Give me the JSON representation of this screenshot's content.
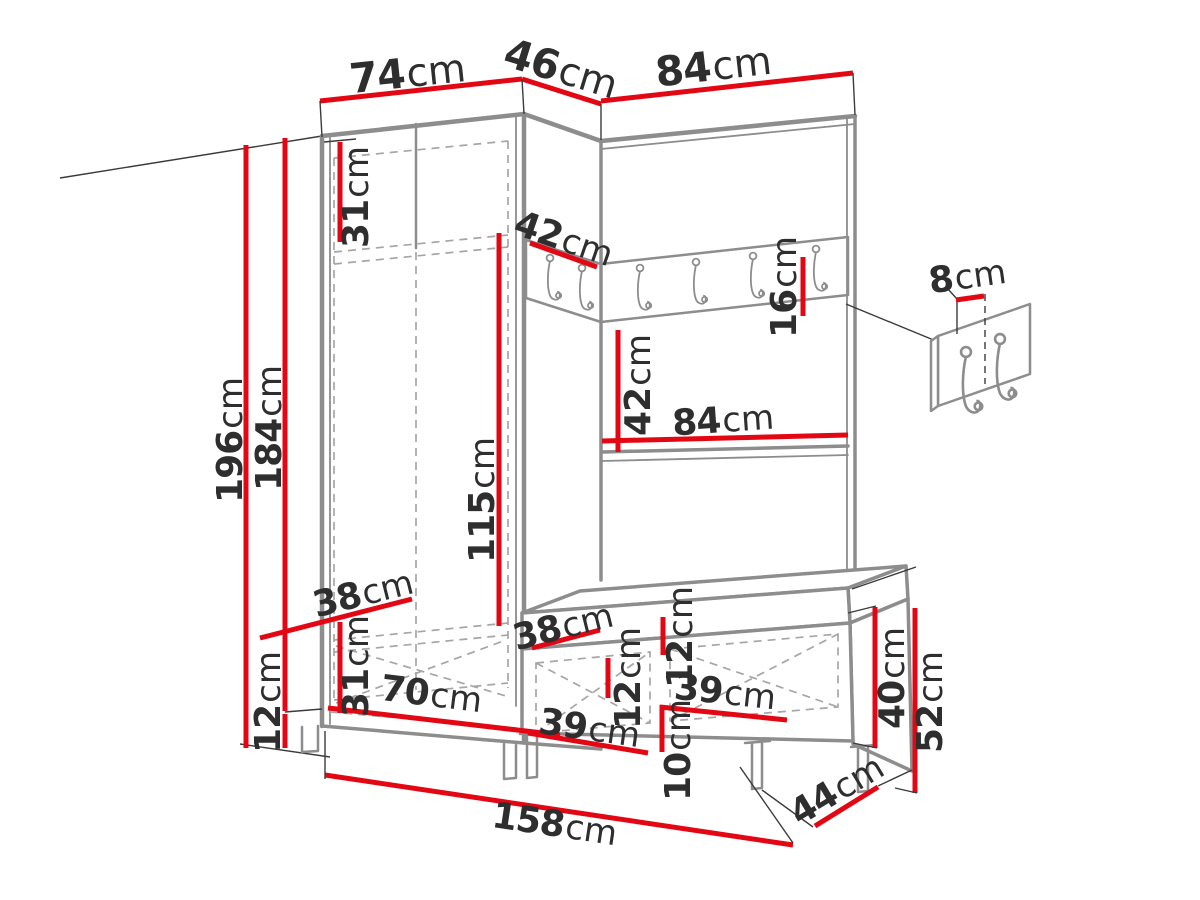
{
  "meta": {
    "unit": "cm",
    "diagram": "hallway-furniture-set-dimensions"
  },
  "colors": {
    "red": "#e30613",
    "gray": "#8d8d8d",
    "gray_light": "#b4b4b4",
    "dash": "#a6a6a6",
    "ink": "#2e2e2e",
    "black": "#3b3b3b",
    "bg": "#ffffff"
  },
  "dims": [
    {
      "id": "wardrobe-width-top",
      "v": "74",
      "u": "cm"
    },
    {
      "id": "corner-width-top",
      "v": "46",
      "u": "cm"
    },
    {
      "id": "panel-width-top",
      "v": "84",
      "u": "cm"
    },
    {
      "id": "top-shelf-height",
      "v": "31",
      "u": "cm"
    },
    {
      "id": "corner-shelf-width",
      "v": "42",
      "u": "cm"
    },
    {
      "id": "hook-rail-height",
      "v": "16",
      "u": "cm"
    },
    {
      "id": "hanging-space-height",
      "v": "115",
      "u": "cm"
    },
    {
      "id": "total-height",
      "v": "196",
      "u": "cm"
    },
    {
      "id": "side-panel-height",
      "v": "184",
      "u": "cm"
    },
    {
      "id": "rail-to-shelf-height",
      "v": "42",
      "u": "cm"
    },
    {
      "id": "shelf-width",
      "v": "84",
      "u": "cm"
    },
    {
      "id": "hook-spacing-detail",
      "v": "8",
      "u": "cm"
    },
    {
      "id": "wardrobe-depth",
      "v": "38",
      "u": "cm"
    },
    {
      "id": "bottom-section-height",
      "v": "31",
      "u": "cm"
    },
    {
      "id": "plinth-height",
      "v": "12",
      "u": "cm"
    },
    {
      "id": "interior-width",
      "v": "70",
      "u": "cm"
    },
    {
      "id": "bench-depth-left",
      "v": "38",
      "u": "cm"
    },
    {
      "id": "cushion-thickness-left",
      "v": "12",
      "u": "cm"
    },
    {
      "id": "cushion-thickness-right",
      "v": "12",
      "u": "cm"
    },
    {
      "id": "bench-compartment-left-width",
      "v": "39",
      "u": "cm"
    },
    {
      "id": "bench-compartment-right-width",
      "v": "39",
      "u": "cm"
    },
    {
      "id": "bench-leg-height",
      "v": "10",
      "u": "cm"
    },
    {
      "id": "bench-body-height",
      "v": "40",
      "u": "cm"
    },
    {
      "id": "bench-total-height",
      "v": "52",
      "u": "cm"
    },
    {
      "id": "bench-depth-right",
      "v": "44",
      "u": "cm"
    },
    {
      "id": "total-width-bottom",
      "v": "158",
      "u": "cm"
    }
  ]
}
